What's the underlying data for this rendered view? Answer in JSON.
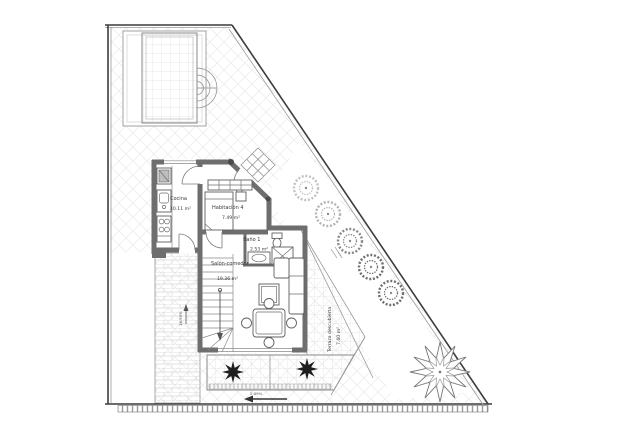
{
  "plan": {
    "rooms": {
      "cocina": {
        "name": "Cocina",
        "area": "10.11 m²"
      },
      "habitacion4": {
        "name": "Habitación 4",
        "area": "7.49 m²"
      },
      "bano1": {
        "name": "Baño 1",
        "area": "2.53 m²"
      },
      "salon": {
        "name": "Salón-comedor",
        "area": "19.36 m²"
      },
      "terraza": {
        "name": "Terraza descubierta",
        "area": "7.60 m²"
      }
    },
    "annotations": {
      "ramp_slope": "16.95%",
      "terrace_slope": "2.09%"
    },
    "colors": {
      "wall": "#6e6e6e",
      "boundary": "#3c3c3c",
      "hatch": "#e8e8e8",
      "plant_dark": "#1f1f1f"
    }
  }
}
